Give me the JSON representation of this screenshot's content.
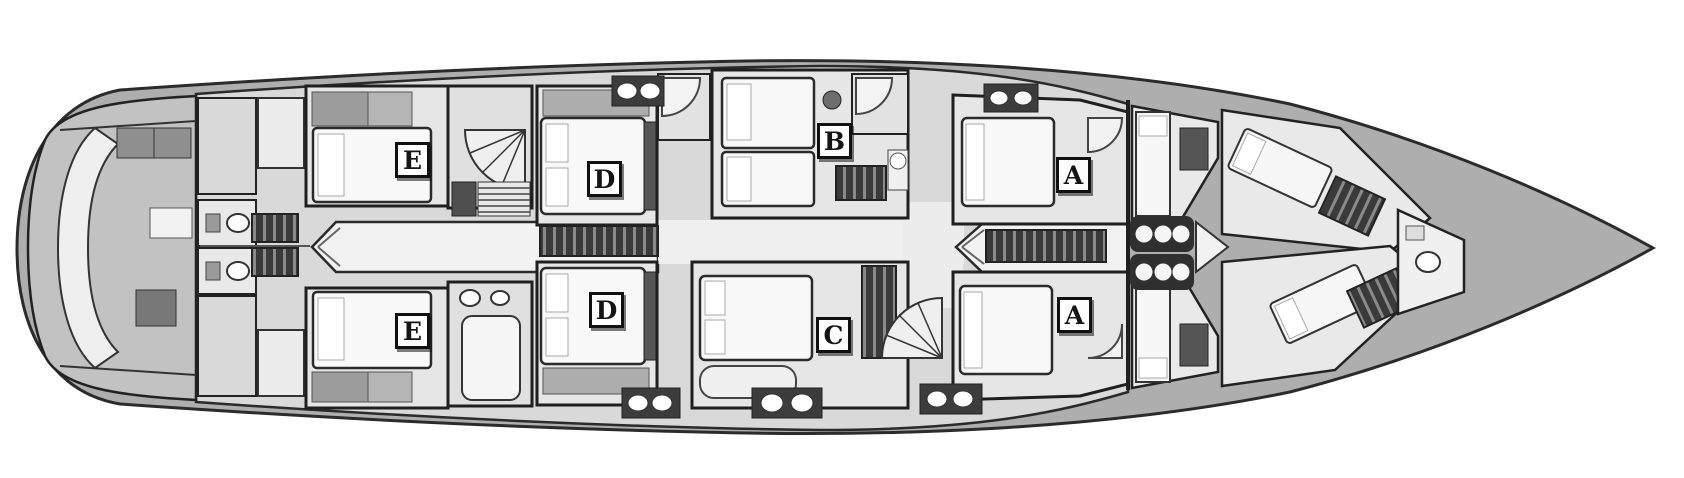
{
  "plan": {
    "description": "Yacht lower deck floor plan, top-down view, bow pointing right",
    "deck_outline": "hull",
    "cabin_count": 8
  },
  "cabin_labels": [
    {
      "id": "cabin-e-port",
      "text": "E"
    },
    {
      "id": "cabin-e-starboard",
      "text": "E"
    },
    {
      "id": "cabin-d-port",
      "text": "D"
    },
    {
      "id": "cabin-d-starboard",
      "text": "D"
    },
    {
      "id": "cabin-b",
      "text": "B"
    },
    {
      "id": "cabin-c",
      "text": "C"
    },
    {
      "id": "cabin-a-port",
      "text": "A"
    },
    {
      "id": "cabin-a-starboard",
      "text": "A"
    }
  ],
  "icons": {
    "toilet": "white-oval",
    "sink_pair": "two-white-ovals-on-dark",
    "corner_shower": "quarter-circle",
    "spiral_stairs": "fan-with-radial-treads",
    "straight_stairs": "parallel-treads",
    "wardrobe": "dark-slatted-strip",
    "double_bed": "rounded-white-rect-with-pillows",
    "crew_seats": "three-circles-row",
    "table": "gray-rect"
  },
  "palette": {
    "background": "#ffffff",
    "hull_deck": "#aeaeae",
    "walls": "#1f1f1f",
    "room_floor": "#e6e6e6",
    "corridor_floor": "#f2f2f2",
    "bed": "#f8f8f8",
    "dark_furniture": "#3c3c3c",
    "mid_gray_furniture": "#9c9c9c",
    "badge_background": "#fdfdfd",
    "badge_border": "#101010"
  }
}
